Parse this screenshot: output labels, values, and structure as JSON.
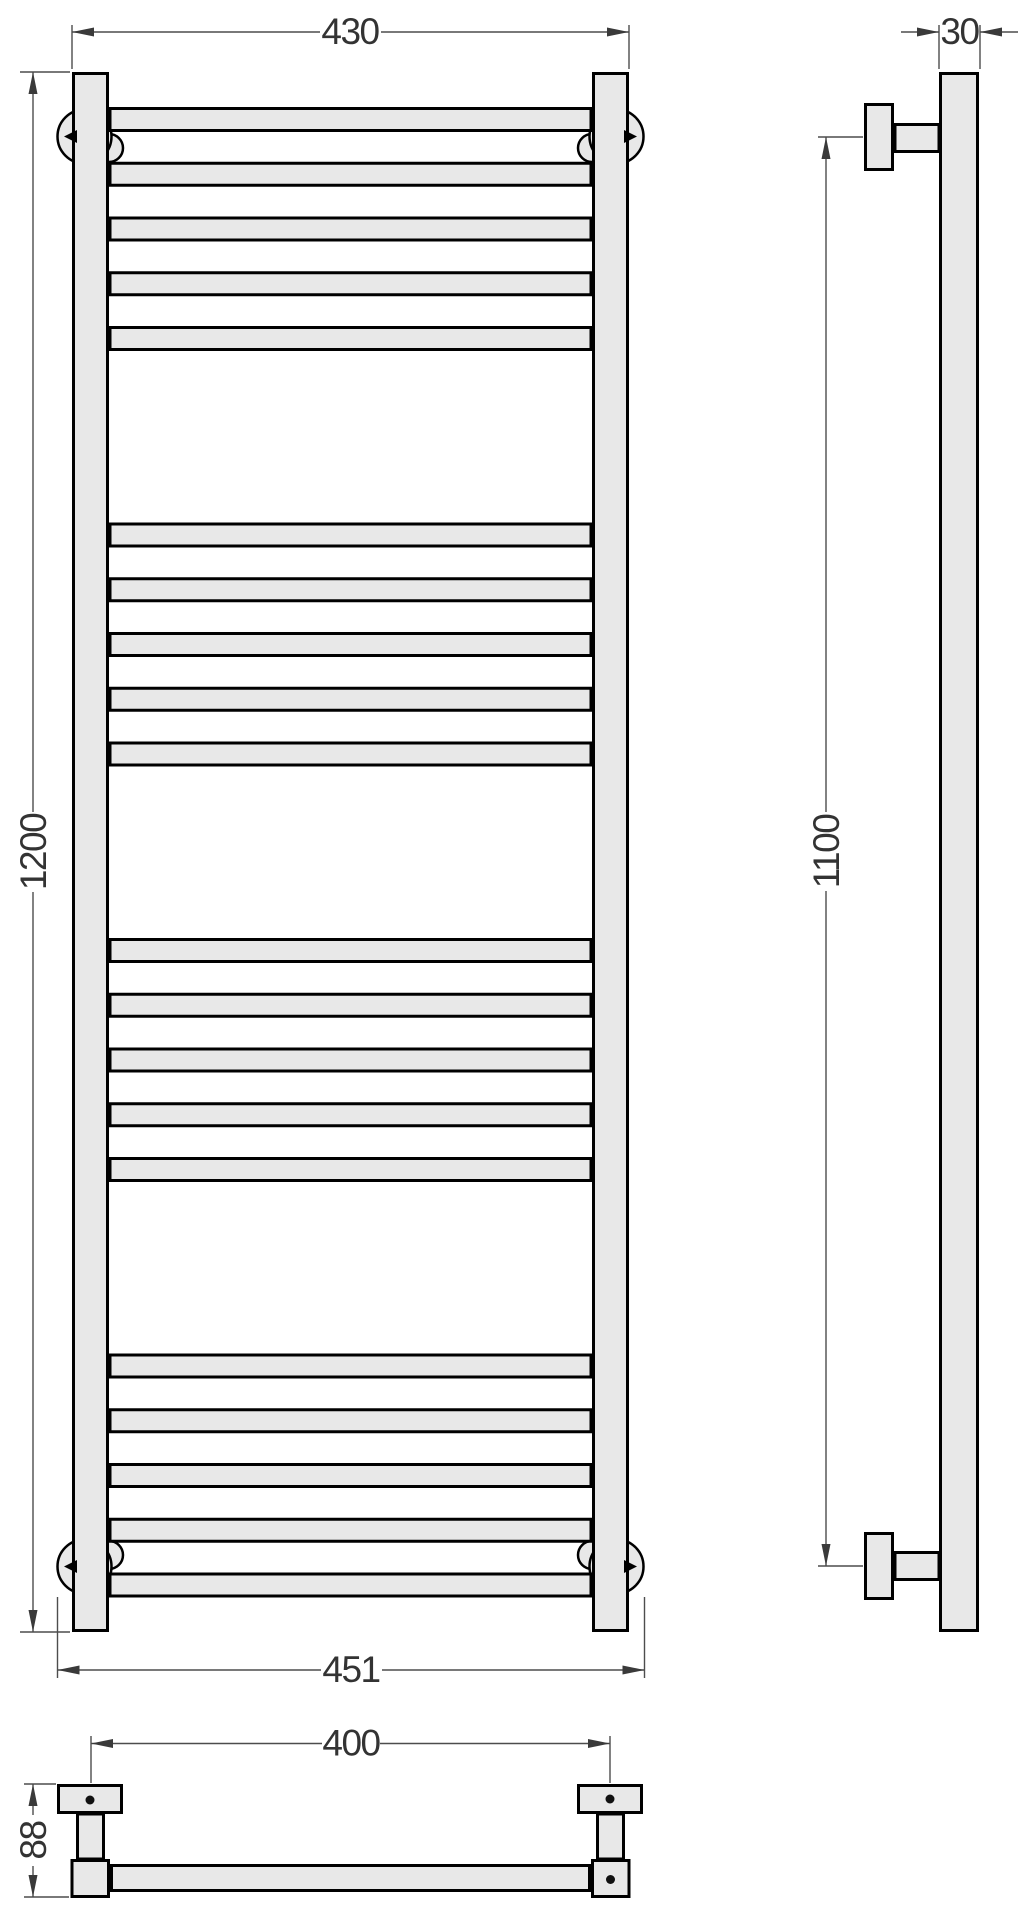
{
  "drawing": {
    "type": "technical-dimension-drawing",
    "subject": "ladder towel rail, three orthographic views",
    "colors": {
      "part_fill": "#e8e8e8",
      "part_outline": "#000000",
      "dimension_line": "#4d4d4d",
      "dimension_text": "#333333",
      "background": "#ffffff"
    },
    "front_view": {
      "dims": {
        "width_top": "430",
        "height": "1200",
        "width_overall_bottom": "451"
      }
    },
    "side_view": {
      "dims": {
        "depth": "30",
        "mount_spacing_vertical": "1100"
      }
    },
    "bottom_view": {
      "dims": {
        "mount_spacing_horizontal": "400",
        "bracket_depth": "88"
      }
    }
  }
}
